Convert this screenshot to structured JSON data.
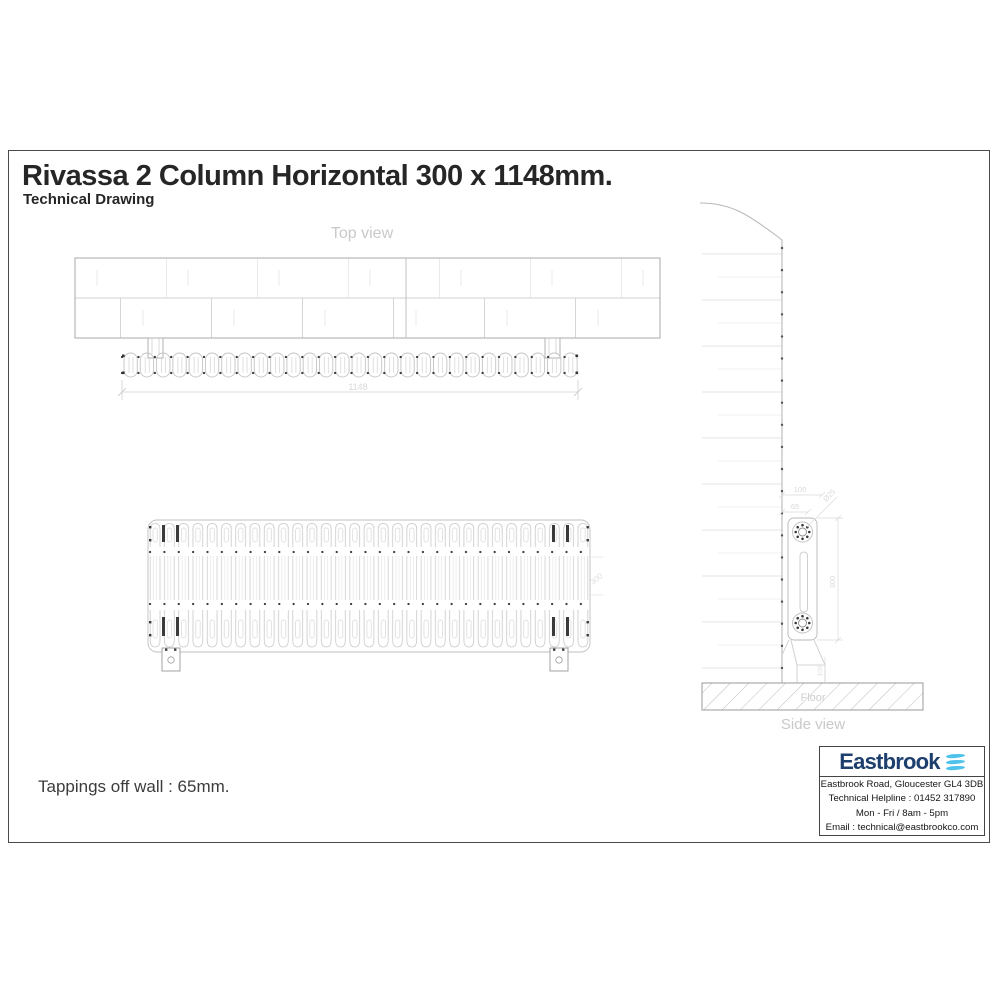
{
  "header": {
    "title": "Rivassa 2 Column Horizontal 300 x 1148mm.",
    "subtitle": "Technical Drawing"
  },
  "top_view": {
    "label": "Top view",
    "width_dim": "1148"
  },
  "front_view": {
    "height_dim": "300"
  },
  "side_view": {
    "label": "Side view",
    "floor_label": "Floor",
    "dim_wall_offset": "100",
    "dim_tapping_offset": "65",
    "dim_tapping_size": "Ø25",
    "dim_height": "300",
    "dim_foot_height": "100"
  },
  "footer": {
    "tappings_note": "Tappings off wall : 65mm."
  },
  "info_box": {
    "brand": "Eastbrook",
    "address": "Eastbrook Road, Gloucester GL4 3DB",
    "helpline": "Technical Helpline : 01452 317890",
    "hours": "Mon - Fri / 8am - 5pm",
    "email": "Email : technical@eastbrookco.com"
  },
  "colors": {
    "brand_navy": "#1c3f6e",
    "brand_blue": "#4fc2ec",
    "drawing_line": "#c4c4c4",
    "label_gray": "#c9c9c9",
    "frame": "#4a4a4a"
  }
}
